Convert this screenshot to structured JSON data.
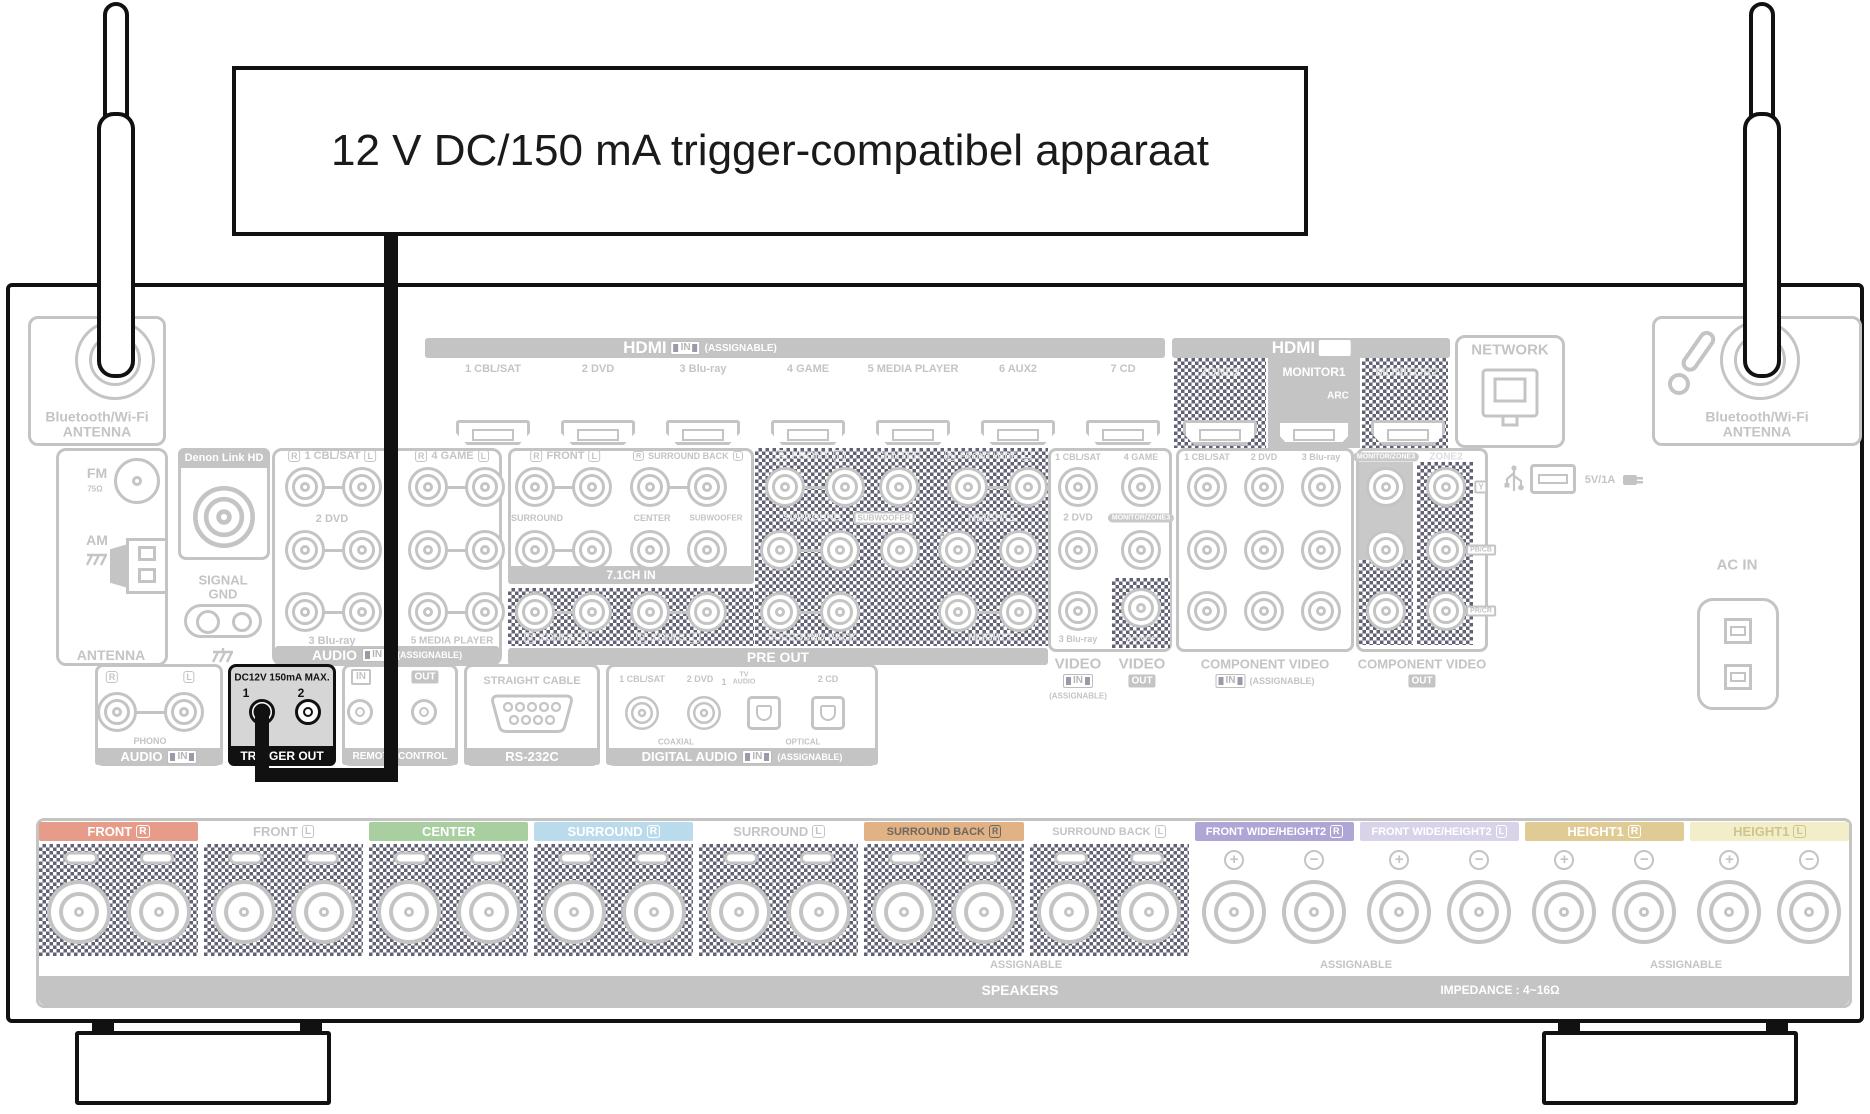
{
  "callout": {
    "label": "12 V DC/150 mA trigger-compatibel apparaat"
  },
  "hdmi_in": {
    "title": "HDMI",
    "badge": "IN",
    "assignable": "(ASSIGNABLE)",
    "inputs": [
      "1 CBL/SAT",
      "2 DVD",
      "3 Blu-ray",
      "4 GAME",
      "5 MEDIA PLAYER",
      "6 AUX2",
      "7 CD"
    ]
  },
  "hdmi_out": {
    "title": "HDMI",
    "badge": "OUT",
    "zone2": "ZONE2",
    "monitor1": "MONITOR1",
    "arc": "ARC",
    "monitor2": "MONITOR2"
  },
  "network": {
    "title": "NETWORK"
  },
  "usb": {
    "label": "5V/1A"
  },
  "antenna_left": {
    "line1": "Bluetooth/Wi-Fi",
    "line2": "ANTENNA"
  },
  "antenna_right": {
    "line1": "Bluetooth/Wi-Fi",
    "line2": "ANTENNA"
  },
  "tuner": {
    "fm": "FM",
    "fm_ohm": "75Ω",
    "am": "AM",
    "banner": "ANTENNA"
  },
  "denon_link": {
    "title": "Denon Link HD"
  },
  "signal_gnd": {
    "line1": "SIGNAL",
    "line2": "GND"
  },
  "audio_in": {
    "r": "R",
    "l": "L",
    "in1": "1 CBL/SAT",
    "in2": "2 DVD",
    "in3": "3 Blu-ray",
    "in4": "4 GAME",
    "in5": "5 MEDIA PLAYER",
    "banner": "AUDIO",
    "badge": "IN",
    "assignable": "(ASSIGNABLE)"
  },
  "ch71": {
    "r": "R",
    "l": "L",
    "front": "FRONT",
    "surround_back": "SURROUND BACK",
    "surround": "SURROUND",
    "center": "CENTER",
    "subwoofer": "SUBWOOFER",
    "banner": "7.1CH IN"
  },
  "pre_out": {
    "r": "R",
    "l": "L",
    "front": "FRONT",
    "center": "CENTER",
    "front_wide": "FRONT WIDE",
    "surround": "SURROUND",
    "subwoofer": "SUBWOOFER",
    "sub1": "1",
    "sub2": "2",
    "height1": "HEIGHT1",
    "zone2": "ZONE2",
    "zone3": "ZONE3",
    "surround_back": "SURROUND BACK",
    "height2": "HEIGHT2",
    "banner": "PRE OUT"
  },
  "video": {
    "in1": "1 CBL/SAT",
    "in4": "4 GAME",
    "in2": "2 DVD",
    "in3": "3 Blu-ray",
    "monitor_zone3": "MONITOR/ZONE3",
    "zone2": "ZONE2",
    "in_title": "VIDEO",
    "in_badge": "IN",
    "in_assignable": "(ASSIGNABLE)",
    "out_title": "VIDEO",
    "out_badge": "OUT"
  },
  "component_in": {
    "cols": [
      "1 CBL/SAT",
      "2 DVD",
      "3 Blu-ray"
    ],
    "title": "COMPONENT VIDEO",
    "badge": "IN",
    "assignable": "(ASSIGNABLE)"
  },
  "component_out": {
    "monitor_zone3": "MONITOR/ZONE3",
    "zone2": "ZONE2",
    "title": "COMPONENT VIDEO",
    "badge": "OUT",
    "y": "Y",
    "pb": "PB/CB",
    "pr": "PR/CR"
  },
  "phono": {
    "r": "R",
    "l": "L",
    "label": "PHONO",
    "banner": "AUDIO",
    "badge": "IN"
  },
  "trigger": {
    "rating": "DC12V 150mA MAX.",
    "jack1": "1",
    "jack2": "2",
    "banner": "TRIGGER OUT"
  },
  "remote": {
    "in": "IN",
    "out": "OUT",
    "ir": "IR",
    "banner": "REMOTE CONTROL"
  },
  "rs232": {
    "note": "STRAIGHT CABLE",
    "banner": "RS-232C"
  },
  "digital_audio": {
    "in1": "1 CBL/SAT",
    "in2": "2 DVD",
    "opt1_no": "1",
    "opt1_line1": "TV",
    "opt1_line2": "AUDIO",
    "opt2": "2 CD",
    "coaxial": "COAXIAL",
    "optical": "OPTICAL",
    "banner": "DIGITAL AUDIO",
    "badge": "IN",
    "assignable": "(ASSIGNABLE)"
  },
  "ac_in": {
    "label": "AC IN"
  },
  "speakers": {
    "plus": "+",
    "minus": "−",
    "channels": [
      {
        "name": "FRONT",
        "side": "R",
        "bg": "#e79b89",
        "fg": "#ffffff",
        "terminal": "hatch"
      },
      {
        "name": "FRONT",
        "side": "L",
        "bg": "",
        "fg": "#c4c4c4",
        "terminal": "hatch"
      },
      {
        "name": "CENTER",
        "side": "",
        "bg": "#a9cfa1",
        "fg": "#ffffff",
        "terminal": "hatch"
      },
      {
        "name": "SURROUND",
        "side": "R",
        "bg": "#badbeb",
        "fg": "#ffffff",
        "terminal": "hatch"
      },
      {
        "name": "SURROUND",
        "side": "L",
        "bg": "",
        "fg": "#c4c4c4",
        "terminal": "hatch"
      },
      {
        "name": "SURROUND BACK",
        "side": "R",
        "bg": "#e0b286",
        "fg": "#6f675d",
        "terminal": "hatch"
      },
      {
        "name": "SURROUND BACK",
        "side": "L",
        "bg": "",
        "fg": "#c4c4c4",
        "terminal": "hatch"
      },
      {
        "name": "FRONT WIDE/HEIGHT2",
        "side": "R",
        "bg": "#b0a6d6",
        "fg": "#ffffff",
        "terminal": "plusminus"
      },
      {
        "name": "FRONT WIDE/HEIGHT2",
        "side": "L",
        "bg": "#d9d3ea",
        "fg": "#ffffff",
        "terminal": "plusminus"
      },
      {
        "name": "HEIGHT1",
        "side": "R",
        "bg": "#e0cb94",
        "fg": "#ffffff",
        "terminal": "plusminus"
      },
      {
        "name": "HEIGHT1",
        "side": "L",
        "bg": "#f2eec9",
        "fg": "#cfc48e",
        "terminal": "plusminus"
      }
    ],
    "assignable": "ASSIGNABLE",
    "banner": "SPEAKERS",
    "impedance": "IMPEDANCE : 4~16Ω"
  }
}
